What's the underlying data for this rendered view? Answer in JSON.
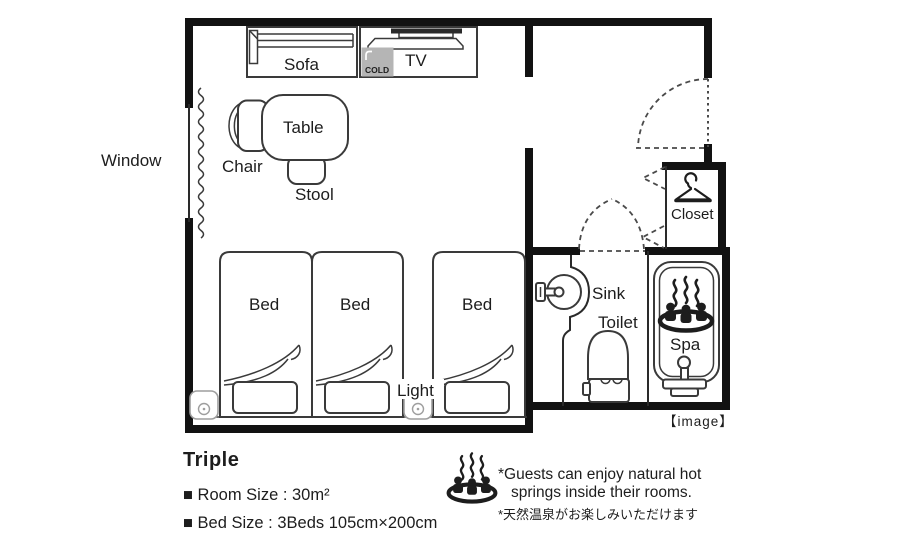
{
  "colors": {
    "line": "#1d1d1d",
    "wall": "#121212",
    "fridge_gray": "#b5b5b5"
  },
  "plan": {
    "labels": {
      "window": "Window",
      "sofa": "Sofa",
      "tv": "TV",
      "fridge": "COLD",
      "table": "Table",
      "chair": "Chair",
      "stool": "Stool",
      "beds": [
        "Bed",
        "Bed",
        "Bed"
      ],
      "light": "Light",
      "sink": "Sink",
      "toilet": "Toilet",
      "spa": "Spa",
      "closet": "Closet",
      "caption": "【image】"
    }
  },
  "info": {
    "room_type": "Triple",
    "room_size": "■ Room Size : 30m²",
    "bed_size": "■ Bed Size : 3Beds 105cm×200cm"
  },
  "note": {
    "en_line1": "*Guests can enjoy natural hot",
    "en_line2": "springs inside their rooms.",
    "ja": "*天然温泉がお楽しみいただけます"
  }
}
